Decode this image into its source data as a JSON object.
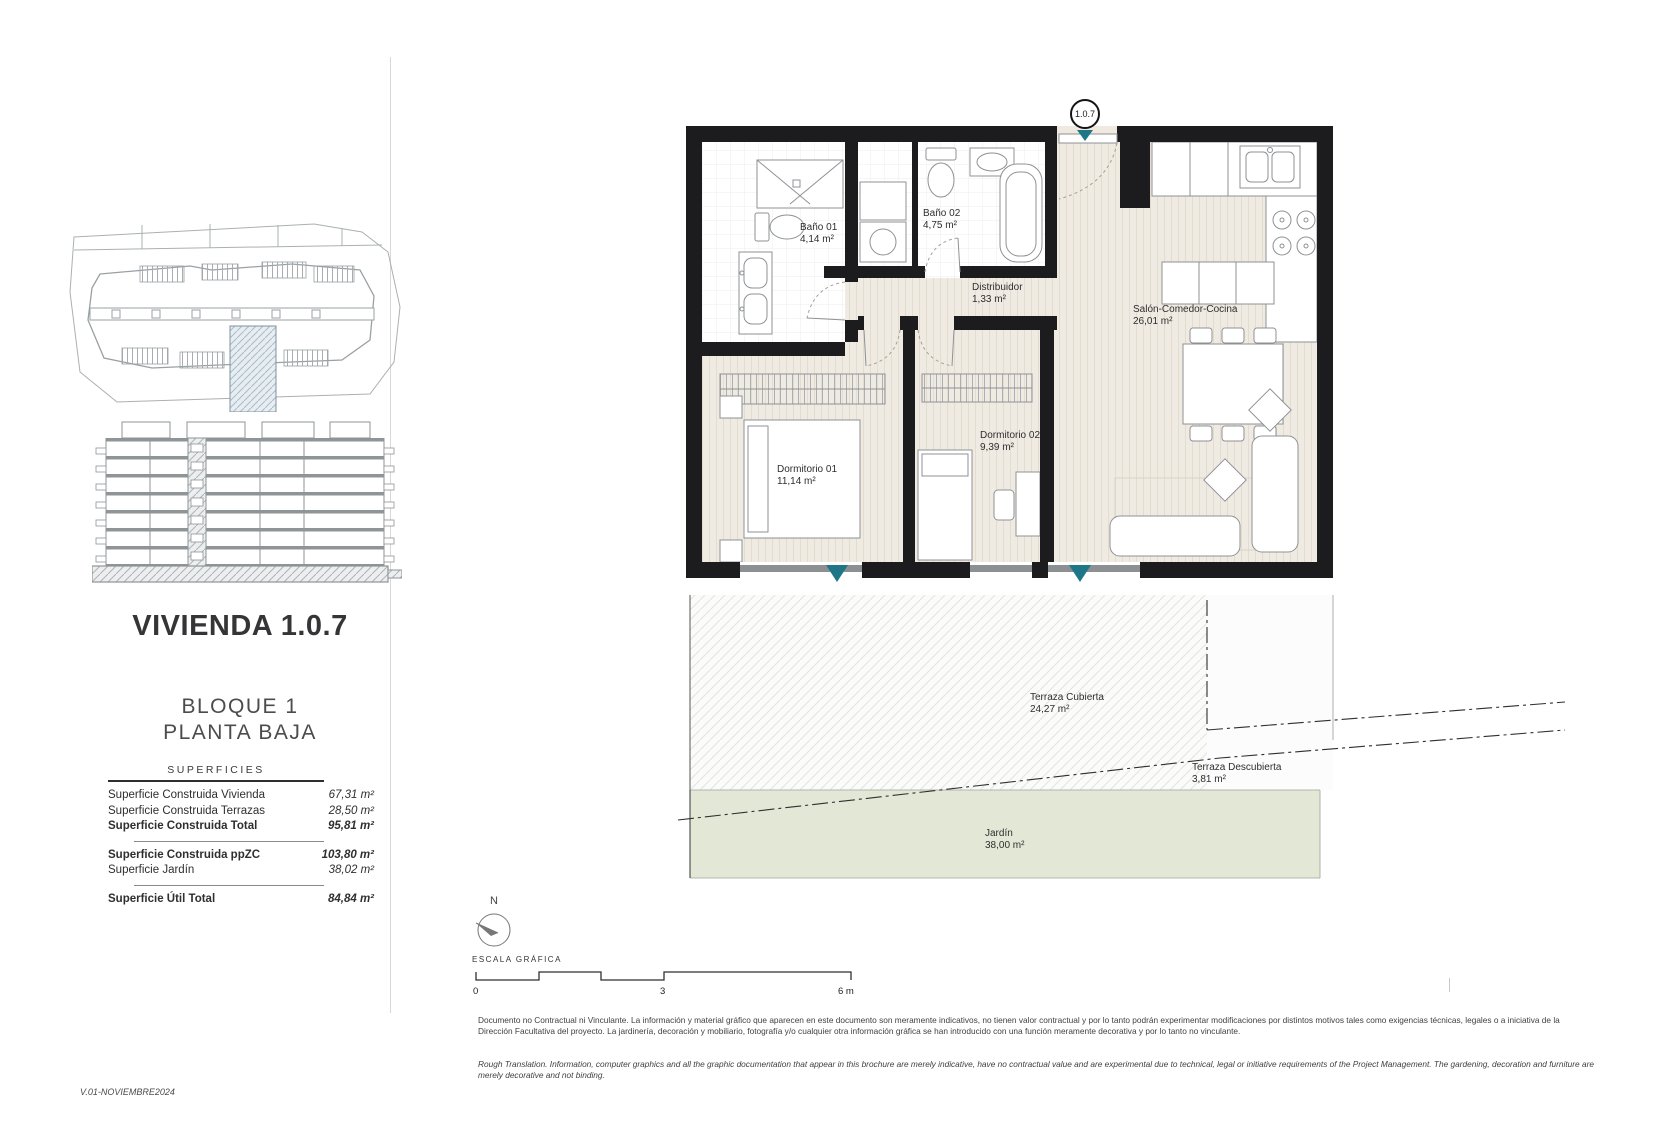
{
  "meta": {
    "version_label": "V.01-NOVIEMBRE2024"
  },
  "unit": {
    "title": "VIVIENDA 1.0.7",
    "block_line1": "BLOQUE 1",
    "block_line2": "PLANTA BAJA",
    "marker": "1.0.7"
  },
  "surfaces": {
    "header": "SUPERFICIES",
    "rows": [
      {
        "label": "Superficie Construida Vivienda",
        "value": "67,31 m²"
      },
      {
        "label": "Superficie Construida Terrazas",
        "value": "28,50 m²"
      },
      {
        "label": "Superficie Construida Total",
        "value": "95,81 m²"
      },
      {
        "label": "Superficie Construida ppZC",
        "value": "103,80 m²"
      },
      {
        "label": "Superficie Jardín",
        "value": "38,02 m²"
      },
      {
        "label": "Superficie Útil Total",
        "value": "84,84 m²"
      }
    ]
  },
  "plan": {
    "rooms": [
      {
        "name": "Baño 01",
        "area": "4,14 m²"
      },
      {
        "name": "Baño 02",
        "area": "4,75 m²"
      },
      {
        "name": "Distribuidor",
        "area": "1,33 m²"
      },
      {
        "name": "Salón-Comedor-Cocina",
        "area": "26,01 m²"
      },
      {
        "name": "Dormitorio 01",
        "area": "11,14 m²"
      },
      {
        "name": "Dormitorio 02",
        "area": "9,39 m²"
      },
      {
        "name": "Terraza Cubierta",
        "area": "24,27 m²"
      },
      {
        "name": "Terraza Descubierta",
        "area": "3,81 m²"
      },
      {
        "name": "Jardín",
        "area": "38,00 m²"
      }
    ]
  },
  "north": {
    "label": "N"
  },
  "scale": {
    "label": "ESCALA GRÁFICA",
    "ticks": [
      "0",
      "3",
      "6 m"
    ]
  },
  "disclaimer": {
    "spanish": "Documento no Contractual ni Vinculante. La información y material gráfico que aparecen en este documento son meramente indicativos, no tienen valor contractual y por lo tanto podrán experimentar modificaciones por distintos motivos tales como exigencias técnicas, legales o a iniciativa de la Dirección Facultativa del proyecto. La jardinería, decoración y mobiliario, fotografía y/o cualquier otra información gráfica se han introducido con una función meramente decorativa y por lo tanto no vinculante.",
    "english": "Rough Translation. Information, computer graphics and all the graphic documentation that appear in this brochure are merely indicative, have no contractual value and are experimental due to technical, legal or initiative requirements of the Project Management. The gardening, decoration and furniture are merely decorative and not binding."
  },
  "colors": {
    "accent_teal": "#1e7687",
    "garden_green": "#e3e8d6",
    "wall_black": "#1c1c1e",
    "floor_cream": "#f0ebe2"
  }
}
